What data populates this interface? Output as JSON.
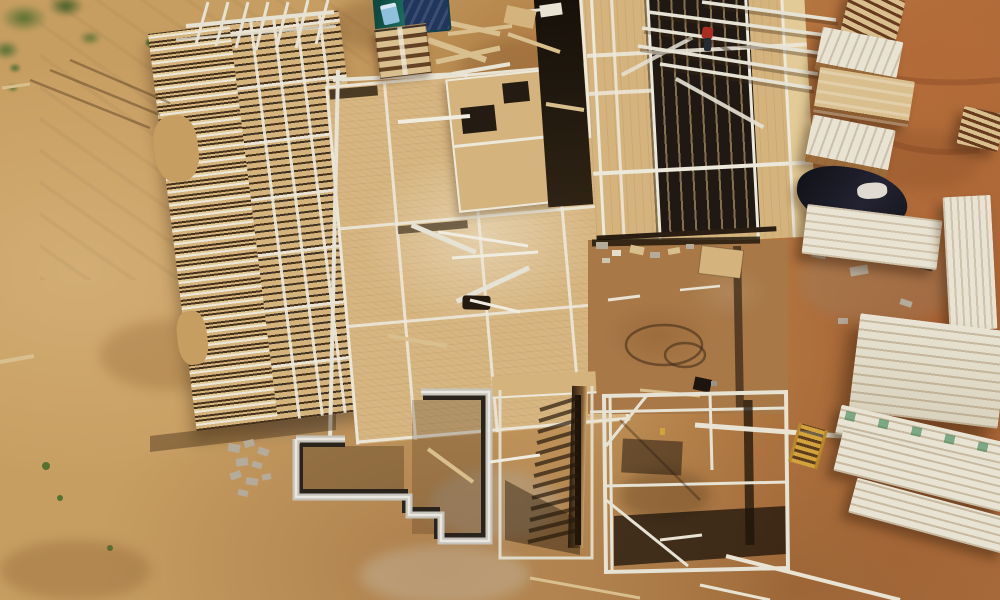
{
  "scene": {
    "type": "aerial-drone-photograph",
    "description": "Top-down aerial view of a new residential construction site: wood floor-joist and stud-wall framing on OSB subfloor decks, a stepped poured-concrete foundation with open basement pit, a worker in a red shirt standing on the framing, stacks of lumber and plywood on red clay dirt to the right, pallets and tarps at top, graded sandy dirt with sparse grass on the left.",
    "objects": [
      "graded sandy dirt lot",
      "grass patches",
      "floor joist framing",
      "stud wall framing on OSB subfloor",
      "OSB subfloor deck",
      "poured concrete foundation walls",
      "basement pit",
      "framed wall casting ladder-like shadows",
      "construction worker in red shirt",
      "wooden pallets",
      "teal tarp with blue cooler",
      "black plastic tarp",
      "stacks of dimensional lumber",
      "plywood sheet stacks",
      "scattered boards and concrete blocks",
      "garden hose",
      "yellow ladder",
      "red clay dirt with tire tracks"
    ]
  },
  "palette": {
    "sand": "#c79e62",
    "sand_light": "#d2ad74",
    "sand_dark": "#ab8149",
    "brown": "#a87847",
    "red_dirt": "#b26a38",
    "osb": "#d5b37d",
    "osb_light": "#e3cb97",
    "plate": "#ece8da",
    "beam_white": "#e6e2d4",
    "joist_dark": "#47321c",
    "void_dark": "#201913",
    "concrete": "#c6c3bb",
    "concrete_dark": "#2a231b",
    "lumber_cream": "#e8e3d2",
    "lumber_tan": "#d9bf8d",
    "tarp_teal": "#1d6f60",
    "tarp_navy": "#20365c",
    "tarp_black": "#16161c",
    "blue_item": "#8fc0dc",
    "worker_red": "#aa2d22",
    "grass_green": "#55702f",
    "gravel": "#b5ab9b",
    "ladder_yellow": "#d2a33c",
    "shadow_brown": "#3a2a16"
  }
}
